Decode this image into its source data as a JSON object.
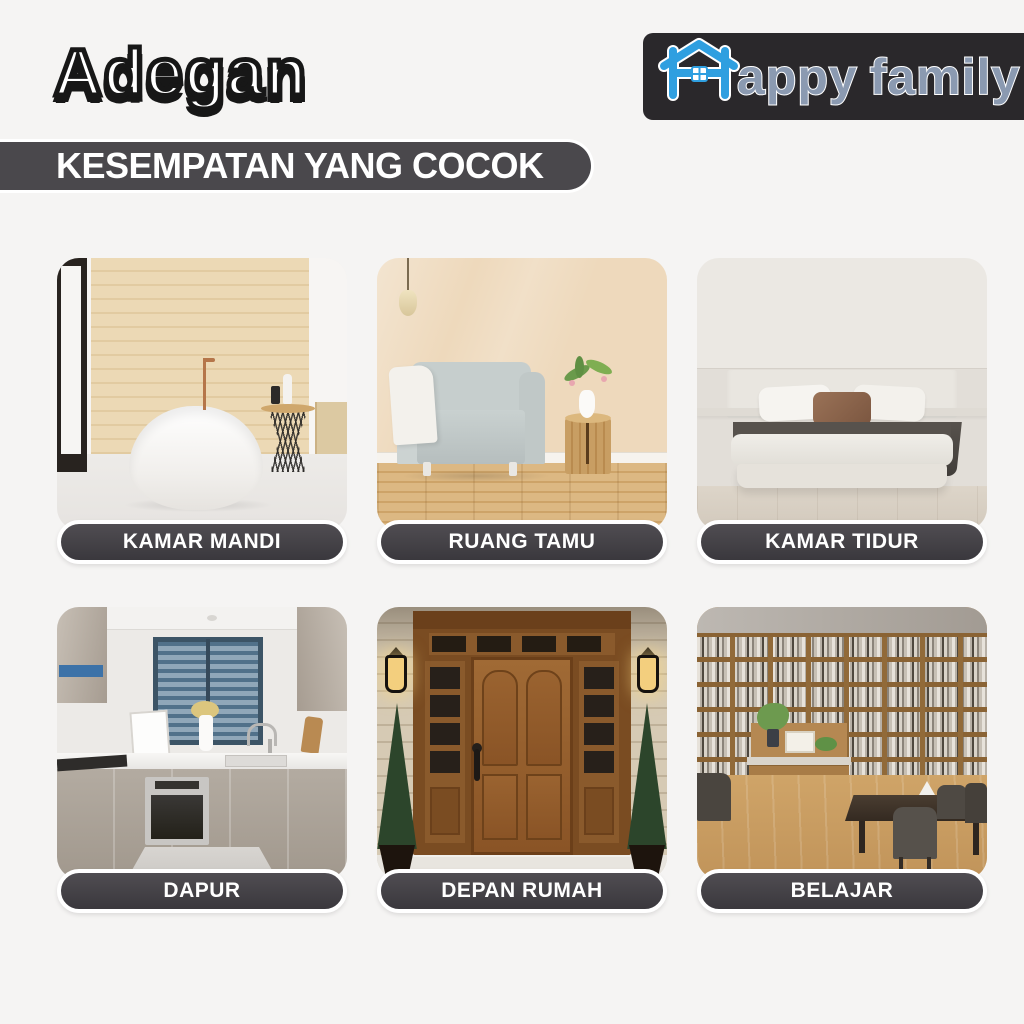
{
  "header": {
    "title": "Adegan",
    "logo": {
      "name": "Happy Family",
      "part1": "appy",
      "part2": "family",
      "house_blue": "#2f9fe0",
      "letter_color": "#8b9ab1",
      "box_color": "#2a282b"
    }
  },
  "banner": {
    "text": "KESEMPATAN YANG COCOK",
    "background": "#4a484c"
  },
  "cards": [
    {
      "label": "KAMAR MANDI",
      "scene": "bathroom",
      "description": "White freestanding bathtub against light wood-plank wall, copper faucet, black wire side table with toiletries"
    },
    {
      "label": "RUANG TAMU",
      "scene": "living-room",
      "description": "Light gray armchair with white throw on wooden floor, beige wall, wooden stump side table with vase of flowers"
    },
    {
      "label": "KAMAR TIDUR",
      "scene": "bedroom",
      "description": "Low platform bed with white bedding, brown accent pillow and dark runner in a beige minimalist room"
    },
    {
      "label": "DAPUR",
      "scene": "kitchen",
      "description": "U-shaped kitchen with glossy taupe cabinets, white countertop, built-in oven and window with dark blinds"
    },
    {
      "label": "DEPAN RUMAH",
      "scene": "front-door",
      "description": "Wooden front door with arched panels, glass sidelights and transom, lanterns and conical evergreen plants"
    },
    {
      "label": "BELAJAR",
      "scene": "study",
      "description": "Wall-to-wall wooden bookshelves full of books, dark study table with gray chairs on wooden floor"
    }
  ],
  "colors": {
    "page_background": "#f5f4f3",
    "pill_background": "#3a383d",
    "pill_text": "#ffffff",
    "banner_background": "#4a484c",
    "title_fill": "#ffffff",
    "title_outline": "#171717"
  }
}
